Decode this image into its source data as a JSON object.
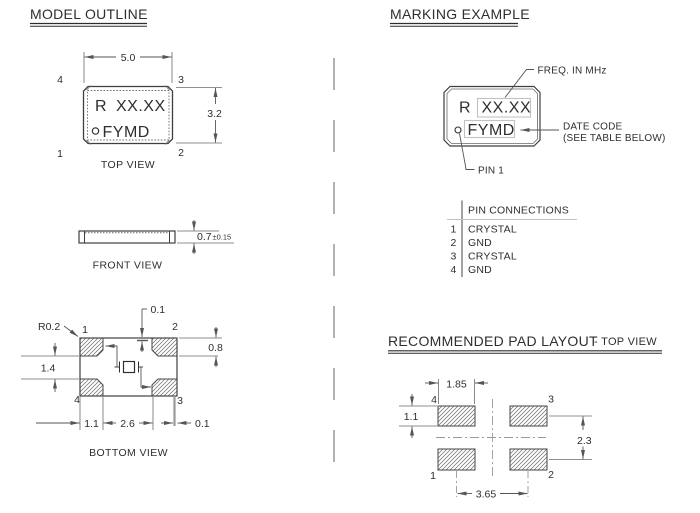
{
  "left": {
    "section_title": "MODEL OUTLINE",
    "top_view": {
      "label": "TOP VIEW",
      "dim_width": "5.0",
      "dim_height": "3.2",
      "marking_prefix": "R",
      "marking_freq": "XX.XX",
      "marking_datecode": "FYMD",
      "pin_top_left": "4",
      "pin_top_right": "3",
      "pin_bottom_left": "1",
      "pin_bottom_right": "2"
    },
    "front_view": {
      "label": "FRONT VIEW",
      "dim_thickness": "0.7",
      "dim_tolerance": "±0.15"
    },
    "bottom_view": {
      "label": "BOTTOM VIEW",
      "corner_radius": "R0.2",
      "dim_top_offset": "0.1",
      "dim_pad_height": "0.8",
      "dim_pad_gap": "1.4",
      "dim_pad_width": "1.1",
      "dim_pad_span": "2.6",
      "dim_side_offset": "0.1",
      "pin_top_left": "1",
      "pin_top_right": "2",
      "pin_bottom_left": "4",
      "pin_bottom_right": "3"
    }
  },
  "right": {
    "section_title": "MARKING EXAMPLE",
    "marking": {
      "prefix": "R",
      "freq_value": "XX.XX",
      "date_code": "FYMD",
      "callout_freq": "FREQ. IN MHz",
      "callout_date_line1": "DATE CODE",
      "callout_date_line2": "(SEE TABLE BELOW)",
      "callout_pin1": "PIN 1"
    },
    "pin_connections": {
      "title": "PIN CONNECTIONS",
      "rows": [
        {
          "pin": "1",
          "connection": "CRYSTAL"
        },
        {
          "pin": "2",
          "connection": "GND"
        },
        {
          "pin": "3",
          "connection": "CRYSTAL"
        },
        {
          "pin": "4",
          "connection": "GND"
        }
      ]
    },
    "pad_layout": {
      "title": "RECOMMENDED PAD LAYOUT",
      "title_suffix": "- TOP VIEW",
      "dim_pad_width": "1.85",
      "dim_pad_height": "1.1",
      "dim_vertical_pitch": "2.3",
      "dim_horizontal_pitch": "3.65",
      "pin_top_left": "4",
      "pin_top_right": "3",
      "pin_bottom_left": "1",
      "pin_bottom_right": "2"
    }
  },
  "colors": {
    "line_body": "#3f3f3f",
    "line_dim": "#6a6a6a",
    "line_light": "#9a9a9a",
    "box_highlight": "#c2c2c2",
    "text": "#2e2e2e"
  }
}
